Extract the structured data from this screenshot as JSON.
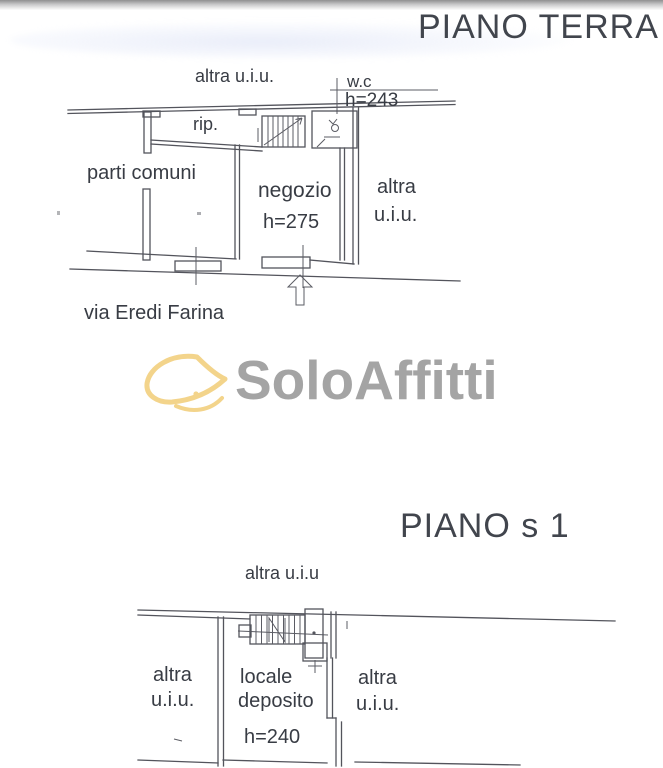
{
  "document": {
    "ground_floor": {
      "title": "PIANO TERRA",
      "labels": {
        "upper_unit": "altra u.i.u.",
        "wc": "w.c",
        "wc_height": "h=243",
        "closet": "rip.",
        "common_areas": "parti comuni",
        "shop": "negozio",
        "shop_height": "h=275",
        "right_unit_line1": "altra",
        "right_unit_line2": "u.i.u.",
        "street": "via Eredi Farina"
      }
    },
    "basement": {
      "title": "PIANO s 1",
      "labels": {
        "upper_unit": "altra u.i.u",
        "left_unit_line1": "altra",
        "left_unit_line2": "u.i.u.",
        "storage_room_line1": "locale",
        "storage_room_line2": "deposito",
        "storage_height": "h=240",
        "right_unit_line1": "altra",
        "right_unit_line2": "u.i.u."
      }
    },
    "watermark": {
      "brand": "SoloAffitti"
    },
    "colors": {
      "plan_line": "#53545c",
      "label_text": "#383c44",
      "title_text": "#41454d",
      "logo_text": "#a4a4a4",
      "logo_leaf": "#f3d48b"
    }
  }
}
